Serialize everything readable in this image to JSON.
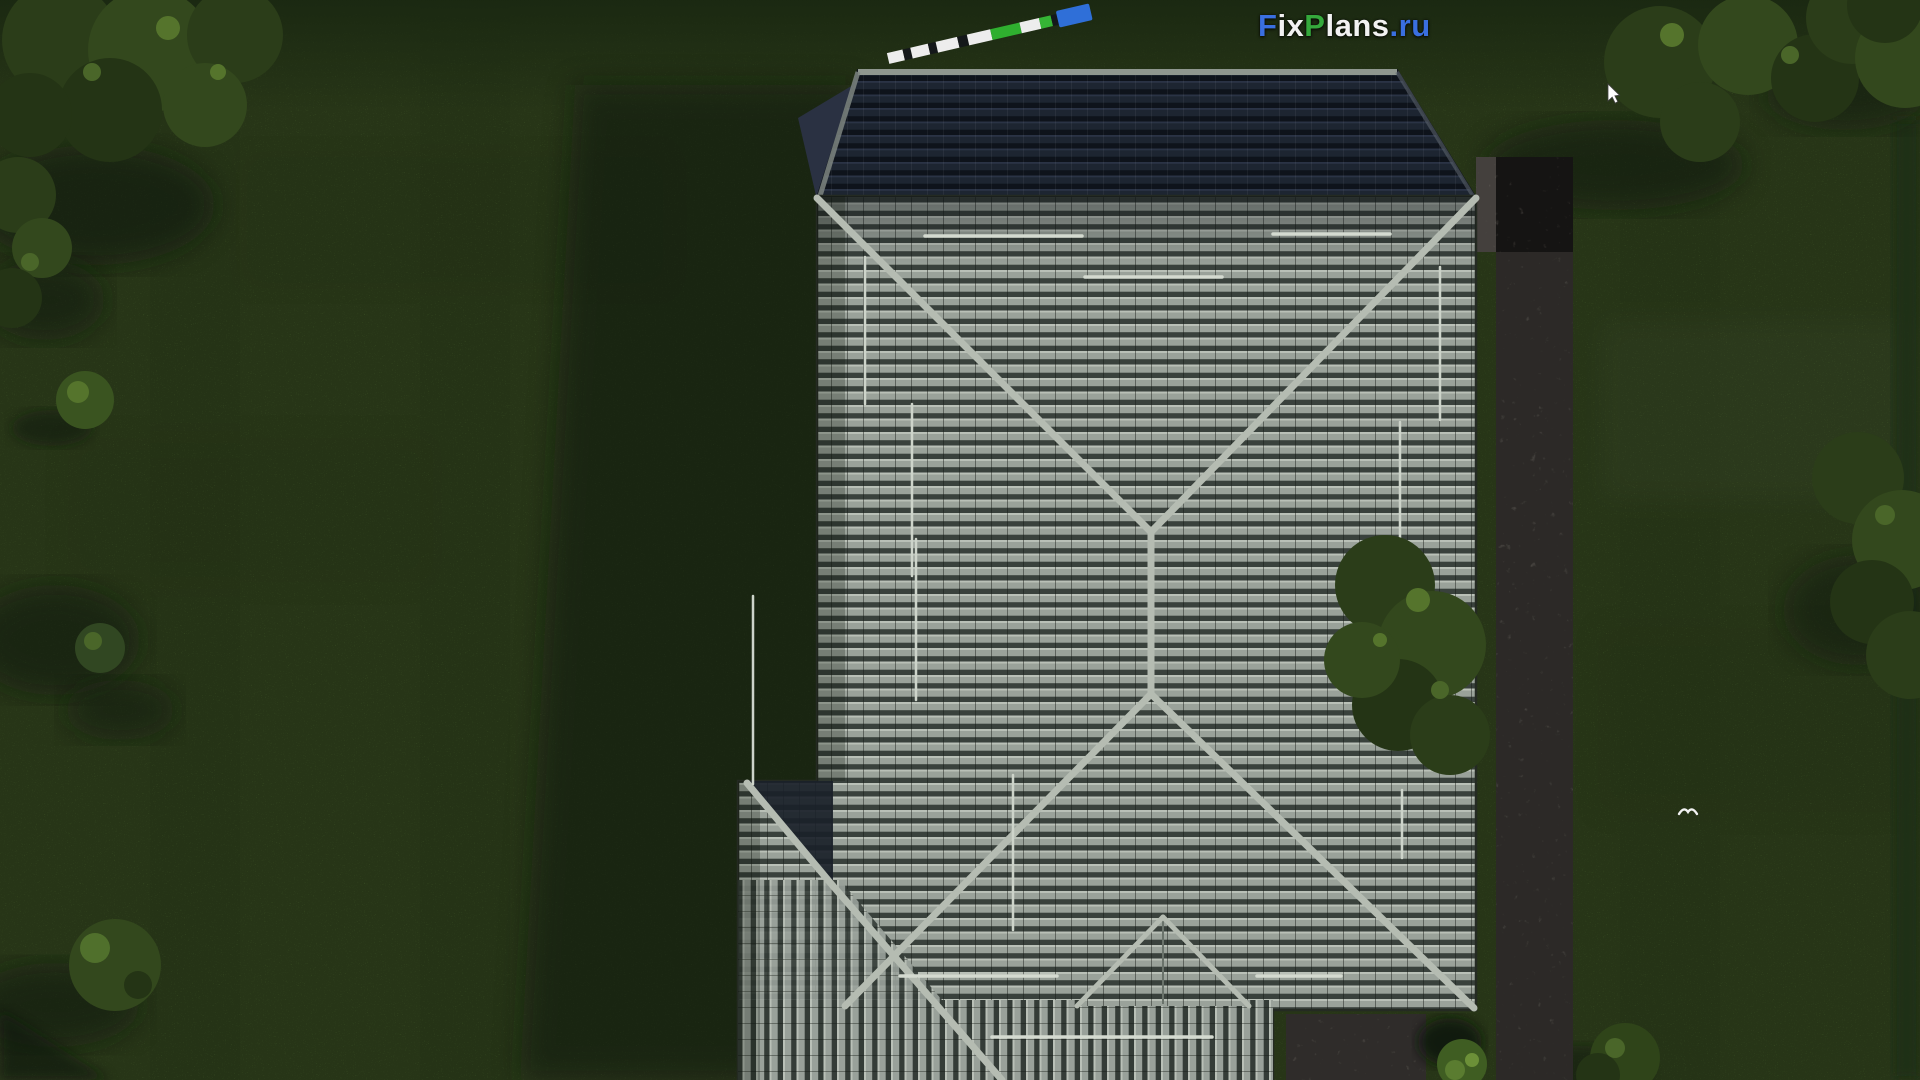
{
  "watermark": {
    "text": "FixPlans.ru",
    "parts": [
      {
        "text": "F",
        "color": "#3a6fe0"
      },
      {
        "text": "ix",
        "color": "#f2f2f2"
      },
      {
        "text": "P",
        "color": "#35a93c"
      },
      {
        "text": "lans",
        "color": "#f2f2f2"
      },
      {
        "text": ".ru",
        "color": "#3a6fe0"
      }
    ]
  },
  "scene": {
    "view": "top-down aerial",
    "subject": "single-family house with gray tiled hip roof",
    "environment": "green lawn with trees, bushes, shadows and stone walkways",
    "features": [
      "dark upper roof section",
      "ridge caps",
      "snow guard bars",
      "stone path right side",
      "stone patio bottom right",
      "round bush near patio"
    ]
  },
  "palette": {
    "grass": "#4f6c30",
    "grass_dark": "#24351a",
    "shadow": "#121d0a",
    "roof_tile_light": "#9aa29a",
    "roof_tile_dark": "#39413c",
    "roof_dark_section": "#1c2430",
    "ridge_cap": "#b5bcb2",
    "snow_guard": "#d4dad0",
    "stone": "#8a837c",
    "tree_dark": "#2b3d19",
    "tree_light": "#4a6629",
    "logo_blue": "#3a6fe0",
    "logo_green": "#35a93c",
    "logo_white": "#f2f2f2"
  },
  "scalebar": {
    "angle_deg": -13,
    "segments": [
      {
        "color": "#ededed",
        "w": 16,
        "tall": false
      },
      {
        "color": "#14181a",
        "w": 8,
        "tall": false
      },
      {
        "color": "#ededed",
        "w": 18,
        "tall": false
      },
      {
        "color": "#14181a",
        "w": 8,
        "tall": false
      },
      {
        "color": "#ededed",
        "w": 22,
        "tall": false
      },
      {
        "color": "#14181a",
        "w": 10,
        "tall": false
      },
      {
        "color": "#ededed",
        "w": 24,
        "tall": false
      },
      {
        "color": "#2faf2f",
        "w": 30,
        "tall": false
      },
      {
        "color": "#ededed",
        "w": 20,
        "tall": false
      },
      {
        "color": "#35b535",
        "w": 12,
        "tall": false
      },
      {
        "color": "#14181a",
        "w": 6,
        "tall": false
      },
      {
        "color": "#2f6fd8",
        "w": 34,
        "tall": true
      }
    ]
  },
  "overlays": {
    "cursor": "white arrow cursor",
    "bird": "small white bird in flight"
  }
}
